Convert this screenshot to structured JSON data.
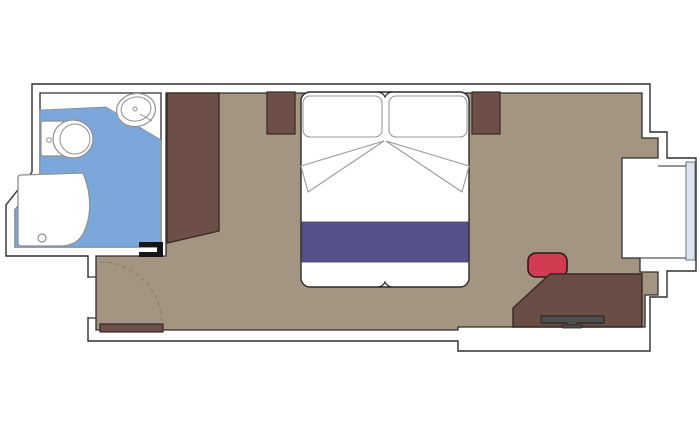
{
  "floorplan": {
    "kind": "cruise-cabin-floor-plan",
    "rooms": [
      "bathroom",
      "sleeping-area",
      "entry-corridor",
      "window-bay"
    ],
    "canvas": {
      "w": 700,
      "h": 433,
      "bg": "#ffffff"
    },
    "palette": {
      "wall": "#2f2f2f",
      "floor": "#a39581",
      "bath": "#7ba7da",
      "wood": "#6d4f47",
      "desk": "#694c44",
      "stripe": "#575189",
      "chair": "#d23c52",
      "fix": "#8f8f8f",
      "glass": "#dde6f0",
      "tv": "#4f4f4f",
      "arc": "#8a7d6d",
      "black": "#151515"
    },
    "shapes": [
      {
        "name": "outer-wall-outline",
        "kind": "path",
        "d": "M32,84 L650,84 L650,132 L667,132 L667,158 L696,158 L696,271 L667,271 L667,297 L650,297 L650,351 L458,351 L458,341 L88,341 L88,256 L6,256 L6,205 L32,172 Z",
        "fill": "#ffffff",
        "stroke": "$wall",
        "sw": 1.4
      },
      {
        "name": "room-floor",
        "kind": "path",
        "d": "M166,93 L642,93 L642,138 L658,138 L658,158 L622,158 L622,258 L640,258 L640,272 L658,272 L658,295 L645,295 L645,327 L458,327 L458,330 L96,330 L96,256 L166,256 Z",
        "fill": "$floor",
        "stroke": "$wall",
        "sw": 1.3
      },
      {
        "name": "bathroom-room",
        "kind": "path",
        "d": "M40,93 L161,93 L161,247 L15,247 L15,210 L40,176 Z",
        "fill": "#ffffff",
        "stroke": "$wall",
        "sw": 1.3
      },
      {
        "name": "bathroom-floor",
        "kind": "path",
        "d": "M40,110 L106,107 L161,140 L161,247 L15,247 L15,210 L40,176 Z",
        "fill": "$bath",
        "stroke": "#7d8ea0",
        "sw": 0.8
      },
      {
        "name": "window-glass",
        "kind": "rect",
        "x": 686,
        "y": 162,
        "w": 9,
        "h": 98,
        "rx": 0,
        "fill": "$glass",
        "stroke": "#5a6572",
        "sw": 0.9
      },
      {
        "name": "window-bay-top-line",
        "kind": "line",
        "x1": 658,
        "y1": 166,
        "x2": 686,
        "y2": 166,
        "stroke": "$wall",
        "sw": 1
      },
      {
        "name": "window-bay-bottom-line",
        "kind": "line",
        "x1": 640,
        "y1": 258,
        "x2": 686,
        "y2": 258,
        "stroke": "$wall",
        "sw": 1
      },
      {
        "name": "shower-tray",
        "kind": "path",
        "d": "M21,175 L83,173 C92,194 92,217 83,234 C78,243 69,246 60,246 L21,246 Q18,246 18,243 L18,178 Q18,175 21,175 Z",
        "fill": "#ffffff",
        "stroke": "$fix",
        "sw": 1.3
      },
      {
        "name": "shower-drain",
        "kind": "circle",
        "cx": 42,
        "cy": 238,
        "r": 4,
        "fill": "none",
        "stroke": "$fix",
        "sw": 1.2
      },
      {
        "name": "toilet-tank",
        "kind": "rect",
        "x": 41,
        "y": 121,
        "w": 23,
        "h": 35,
        "rx": 2,
        "fill": "#ffffff",
        "stroke": "$fix",
        "sw": 1.2
      },
      {
        "name": "toilet-bowl",
        "kind": "ellipse",
        "cx": 73,
        "cy": 139,
        "rx": 20,
        "ry": 19,
        "fill": "#ffffff",
        "stroke": "$fix",
        "sw": 1.2
      },
      {
        "name": "toilet-bowl-inner",
        "kind": "ellipse",
        "cx": 75,
        "cy": 139,
        "rx": 15,
        "ry": 15,
        "fill": "none",
        "stroke": "$fix",
        "sw": 1
      },
      {
        "name": "toilet-flush-button",
        "kind": "circle",
        "cx": 49,
        "cy": 140,
        "r": 2.3,
        "fill": "#ffffff",
        "stroke": "$fix",
        "sw": 1
      },
      {
        "name": "sink-basin",
        "kind": "ellipse",
        "cx": 136,
        "cy": 110,
        "rx": 19.5,
        "ry": 16.5,
        "rot": -10,
        "fill": "#ffffff",
        "stroke": "$fix",
        "sw": 1.2
      },
      {
        "name": "sink-basin-inner",
        "kind": "ellipse",
        "cx": 136,
        "cy": 109,
        "rx": 15,
        "ry": 12,
        "rot": -10,
        "fill": "none",
        "stroke": "$fix",
        "sw": 1
      },
      {
        "name": "sink-drain",
        "kind": "circle",
        "cx": 135,
        "cy": 109,
        "r": 2,
        "fill": "none",
        "stroke": "$fix",
        "sw": 1
      },
      {
        "name": "sink-detail-line",
        "kind": "line",
        "x1": 140,
        "y1": 114,
        "x2": 152,
        "y2": 121,
        "stroke": "$fix",
        "sw": 1
      },
      {
        "name": "wardrobe",
        "kind": "path",
        "d": "M167,93 L219,93 L219,231 L167,243 Z",
        "fill": "$wood",
        "stroke": "#382823",
        "sw": 1.3
      },
      {
        "name": "nightstand-left",
        "kind": "rect",
        "x": 267,
        "y": 92,
        "w": 28,
        "h": 42,
        "rx": 0,
        "fill": "$wood",
        "stroke": "#382823",
        "sw": 1.2
      },
      {
        "name": "nightstand-right",
        "kind": "rect",
        "x": 472,
        "y": 92,
        "w": 28,
        "h": 42,
        "rx": 0,
        "fill": "$wood",
        "stroke": "#382823",
        "sw": 1.2
      },
      {
        "name": "double-bed",
        "kind": "rect",
        "x": 301,
        "y": 92,
        "w": 168,
        "h": 195,
        "rx": 9,
        "fill": "#ffffff",
        "stroke": "#2b2b2b",
        "sw": 1.4
      },
      {
        "name": "pillow-left",
        "kind": "rect",
        "x": 303,
        "y": 96,
        "w": 79,
        "h": 41,
        "rx": 7,
        "fill": "#ffffff",
        "stroke": "#9a9a9a",
        "sw": 1.1
      },
      {
        "name": "pillow-right",
        "kind": "rect",
        "x": 389,
        "y": 96,
        "w": 78,
        "h": 41,
        "rx": 7,
        "fill": "#ffffff",
        "stroke": "#9a9a9a",
        "sw": 1.1
      },
      {
        "name": "sheet-fold-left",
        "kind": "path",
        "d": "M384,141 L301,166 L308,192 Z",
        "fill": "#ffffff",
        "stroke": "#9a9a9a",
        "sw": 1.1
      },
      {
        "name": "sheet-fold-right",
        "kind": "path",
        "d": "M386,141 L469,166 L462,192 Z",
        "fill": "#ffffff",
        "stroke": "#9a9a9a",
        "sw": 1.1
      },
      {
        "name": "bed-runner-stripe",
        "kind": "rect",
        "x": 302,
        "y": 222,
        "w": 166,
        "h": 40,
        "rx": 0,
        "fill": "$stripe",
        "stroke": "#403e6b",
        "sw": 0.8
      },
      {
        "name": "bed-notch-top",
        "kind": "path",
        "d": "M378,92 Q383,92.5 385,97 Q387,92.5 392,92",
        "fill": "none",
        "stroke": "#2b2b2b",
        "sw": 1.2
      },
      {
        "name": "bed-notch-bottom",
        "kind": "path",
        "d": "M378,287 Q383,286.5 385,282 Q387,286.5 392,287",
        "fill": "none",
        "stroke": "#2b2b2b",
        "sw": 1.2
      },
      {
        "name": "desk-chair",
        "kind": "rect",
        "x": 528,
        "y": 253,
        "w": 39,
        "h": 24,
        "rx": 8,
        "fill": "$chair",
        "stroke": "#2a1a16",
        "sw": 1.6
      },
      {
        "name": "desk",
        "kind": "path",
        "d": "M550,274 L642,274 L642,327 L513,327 L513,308 Z",
        "fill": "$desk",
        "stroke": "#3a2a24",
        "sw": 1.4
      },
      {
        "name": "tv-bar",
        "kind": "rect",
        "x": 541,
        "y": 316,
        "w": 63,
        "h": 7,
        "rx": 1,
        "fill": "$tv",
        "stroke": "#1f1f1f",
        "sw": 1
      },
      {
        "name": "tv-stand-stem",
        "kind": "rect",
        "x": 568,
        "y": 322,
        "w": 8,
        "h": 4,
        "rx": 0,
        "fill": "$tv",
        "stroke": "none",
        "sw": 0
      },
      {
        "name": "tv-stand-base",
        "kind": "rect",
        "x": 562,
        "y": 325,
        "w": 20,
        "h": 3,
        "rx": 1,
        "fill": "$tv",
        "stroke": "#1f1f1f",
        "sw": 0.8
      },
      {
        "name": "entry-door-swing-arc",
        "kind": "path",
        "d": "M100,262 A62,62 0 0 1 162,324",
        "fill": "none",
        "stroke": "$arc",
        "sw": 1.2,
        "dash": "4,3.5"
      },
      {
        "name": "entry-door-leaf",
        "kind": "rect",
        "x": 100,
        "y": 324,
        "w": 63,
        "h": 8,
        "rx": 0,
        "fill": "$wood",
        "stroke": "#382823",
        "sw": 1.2
      },
      {
        "name": "bathroom-door-top-bar",
        "kind": "rect",
        "x": 139,
        "y": 242,
        "w": 24,
        "h": 5,
        "rx": 0,
        "fill": "$black",
        "stroke": "none",
        "sw": 0
      },
      {
        "name": "bathroom-door-post",
        "kind": "rect",
        "x": 157,
        "y": 242,
        "w": 6,
        "h": 15,
        "rx": 0,
        "fill": "$black",
        "stroke": "none",
        "sw": 0
      },
      {
        "name": "bathroom-door-bottom-bar",
        "kind": "rect",
        "x": 139,
        "y": 252,
        "w": 24,
        "h": 5,
        "rx": 0,
        "fill": "$black",
        "stroke": "none",
        "sw": 0
      },
      {
        "name": "doorway-gap-mask",
        "kind": "rect",
        "x": 85.5,
        "y": 278,
        "w": 5,
        "h": 39,
        "rx": 0,
        "fill": "#ffffff",
        "stroke": "none",
        "sw": 0
      },
      {
        "name": "doorway-jamb-top",
        "kind": "line",
        "x1": 88,
        "y1": 277,
        "x2": 96,
        "y2": 277,
        "stroke": "$wall",
        "sw": 1.2
      },
      {
        "name": "doorway-jamb-bottom",
        "kind": "line",
        "x1": 88,
        "y1": 318,
        "x2": 96,
        "y2": 318,
        "stroke": "$wall",
        "sw": 1.2
      }
    ]
  }
}
